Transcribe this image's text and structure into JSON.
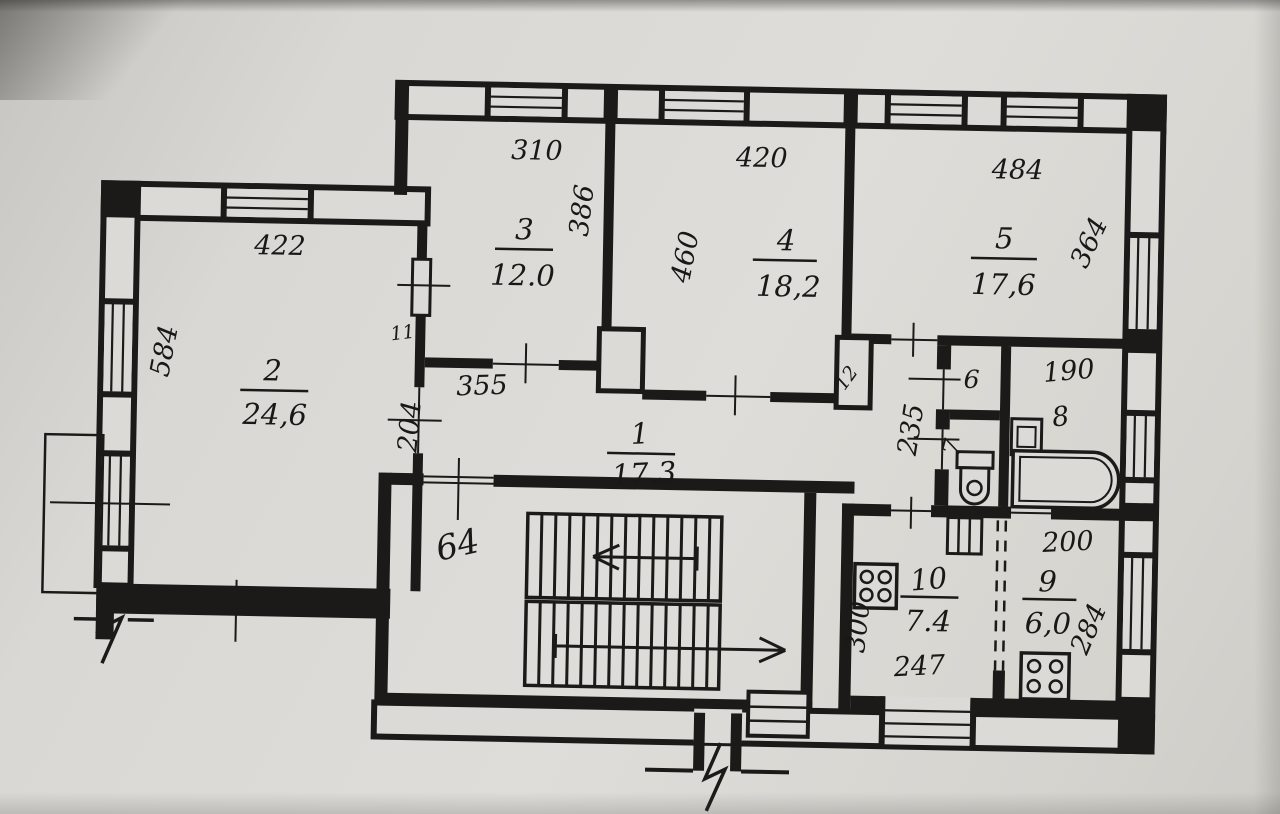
{
  "plan": {
    "rooms": [
      {
        "number": "1",
        "area": "17.3",
        "length": "355",
        "width": "204"
      },
      {
        "number": "2",
        "area": "24,6",
        "width": "422",
        "depth": "584"
      },
      {
        "number": "3",
        "area": "12.0",
        "width": "310",
        "depth": "386"
      },
      {
        "number": "4",
        "area": "18,2",
        "width": "420",
        "depth": "460"
      },
      {
        "number": "5",
        "area": "17,6",
        "width": "484",
        "depth": "364"
      },
      {
        "number": "6"
      },
      {
        "number": "7"
      },
      {
        "number": "8",
        "width": "190"
      },
      {
        "number": "9",
        "area": "6,0",
        "top_width": "200",
        "depth": "284"
      },
      {
        "number": "10",
        "area": "7.4",
        "depth": "300",
        "width": "247"
      }
    ],
    "san_block": {
      "depth": "235"
    },
    "stairwell": {
      "label": "64"
    },
    "vent_shafts": {
      "left": "11",
      "right": "12"
    }
  }
}
